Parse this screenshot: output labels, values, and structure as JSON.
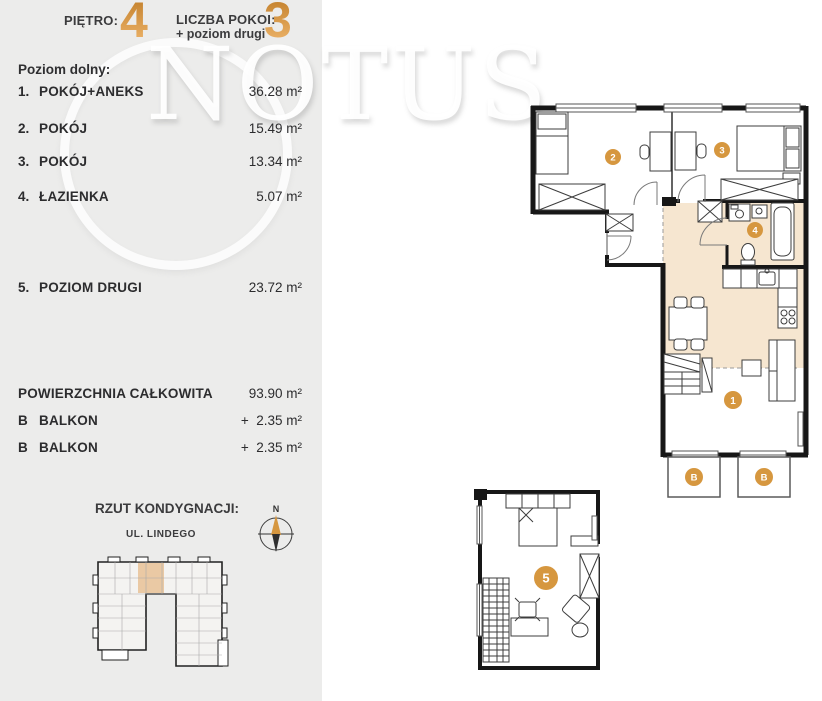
{
  "header": {
    "floor_label": "PIĘTRO:",
    "floor_value": "4",
    "rooms_label": "LICZBA POKOI:",
    "rooms_extra": "+ poziom drugi",
    "rooms_value": "3"
  },
  "watermark": {
    "text": "NOTUS"
  },
  "colors": {
    "accent_orange": "#d6953f",
    "room_fill_beige": "#f6e6d0",
    "wall_black": "#171717",
    "panel_gray": "#ececeb"
  },
  "room_list": {
    "section_label": "Poziom dolny:",
    "rooms": [
      {
        "index": "1.",
        "name": "POKÓJ+ANEKS",
        "area": "36.28 m²"
      },
      {
        "index": "2.",
        "name": "POKÓJ",
        "area": "15.49 m²"
      },
      {
        "index": "3.",
        "name": "POKÓJ",
        "area": "13.34 m²"
      },
      {
        "index": "4.",
        "name": "ŁAZIENKA",
        "area": "5.07 m²"
      },
      {
        "index": "5.",
        "name": "POZIOM DRUGI",
        "area": "23.72 m²"
      }
    ],
    "total": {
      "label": "POWIERZCHNIA CAŁKOWITA",
      "area": "93.90 m²"
    },
    "extras": [
      {
        "index": "B",
        "name": "BALKON",
        "area": "+  2.35 m²"
      },
      {
        "index": "B",
        "name": "BALKON",
        "area": "+  2.35 m²"
      }
    ]
  },
  "floor_overview": {
    "title": "RZUT KONDYGNACJI:",
    "street": "UL. LINDEGO",
    "compass_north": "N"
  },
  "plan_badges": {
    "room1": "1",
    "room2": "2",
    "room3": "3",
    "room4": "4",
    "room5": "5",
    "balcony1": "B",
    "balcony2": "B"
  }
}
